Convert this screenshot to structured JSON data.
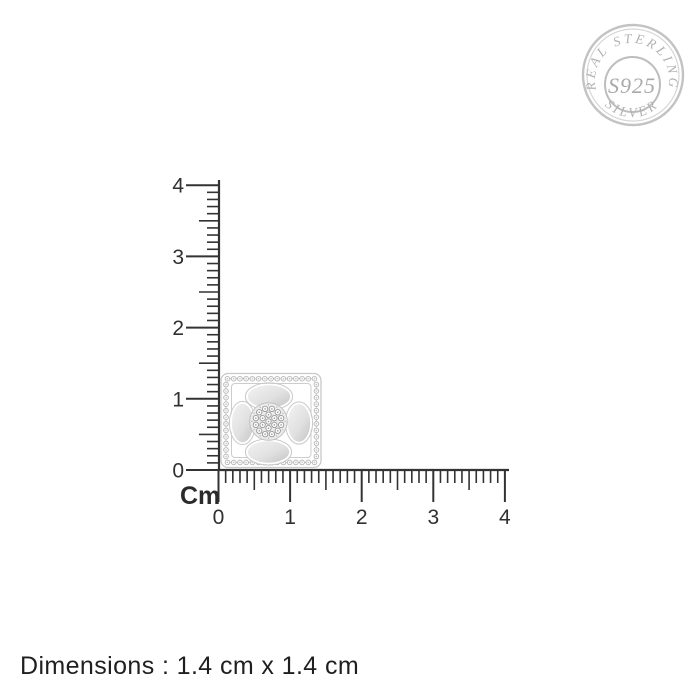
{
  "badge": {
    "arc_top_text": "REAL STERLING",
    "arc_bottom_text": "SILVER",
    "center_text": "S925",
    "color": "#b2b2b2"
  },
  "rulers": {
    "unit_label": "Cm",
    "color": "#333333",
    "minor_ticks_per_unit": 10,
    "vertical": {
      "min": 0,
      "max": 4,
      "tick_labels": [
        "0",
        "1",
        "2",
        "3",
        "4"
      ]
    },
    "horizontal": {
      "min": 0,
      "max": 4,
      "tick_labels": [
        "0",
        "1",
        "2",
        "3",
        "4"
      ]
    }
  },
  "product": {
    "icon": "square-pave-flower-pendant",
    "width_cm": 1.4,
    "height_cm": 1.4
  },
  "footer": {
    "dimensions_text": "Dimensions : 1.4 cm x 1.4 cm"
  }
}
